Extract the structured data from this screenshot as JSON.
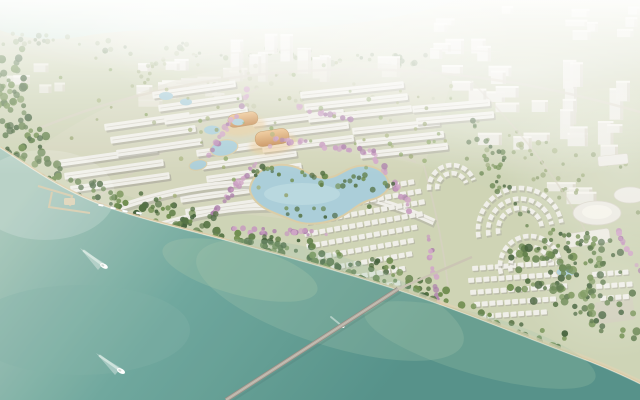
{
  "scene": {
    "type": "aerial-architectural-rendering",
    "description": "Hazy aerial rendering of a riverside township masterplan: long white-roofed shophouse rows and villa clusters amid dense greenery and pink blossom tree-lined streets, a central organic lake, golden landmark halls, a marina, a long bridge over teal water with motorboats, and a foggy white city skyline behind.",
    "colors": {
      "land_base": "#ccd2b4",
      "ground_pale": "#d8d5c0",
      "ground_villa": "#cfd2b2",
      "river_top": "#bedacb",
      "sea_light": "#a6c6ba",
      "sea_mid": "#69a49a",
      "sea_deep": "#4e8d85",
      "sea_shallow": "#9fc3a8",
      "sand": "#d9c8a3",
      "sand_light": "#eadfc2",
      "promenade": "#ddd0b0",
      "road": "#d5cfbf",
      "roof_white": "#f0efe9",
      "roof_shadow": "#aaa89c",
      "ridge": "#d6d3c8",
      "city_white": "#eceae3",
      "city_side": "#d8d4c7",
      "city_top": "#f7f5ef",
      "forest_dark": "#3e5c35",
      "forest_mid": "#4c6b3b",
      "forest_light": "#6b8a4a",
      "olive": "#8a9a5e",
      "blossom_pink": "#c495bd",
      "blossom_deep": "#a87aa8",
      "lake_blue": "#a7ccd8",
      "lake_edge": "#d9cba4",
      "gold_light": "#ecc088",
      "gold_dark": "#c4884e",
      "bridge_deck": "#b5ada3",
      "bridge_edge": "#8c857d",
      "boat_white": "#ffffff",
      "fog": "#ffffff"
    },
    "elements": {
      "moving_boats": 3,
      "moored_boats": 4,
      "marina_piers": 2,
      "golden_landmark_halls": 2,
      "round_civic_halls": 2,
      "bridge": "single long bridge crossing the river at lower center",
      "lake": "two-lobed organic lake at the center of the development",
      "blossom_streets": 8,
      "boat_wakes": "white V-wakes trailing up-left behind each moving boat"
    }
  }
}
